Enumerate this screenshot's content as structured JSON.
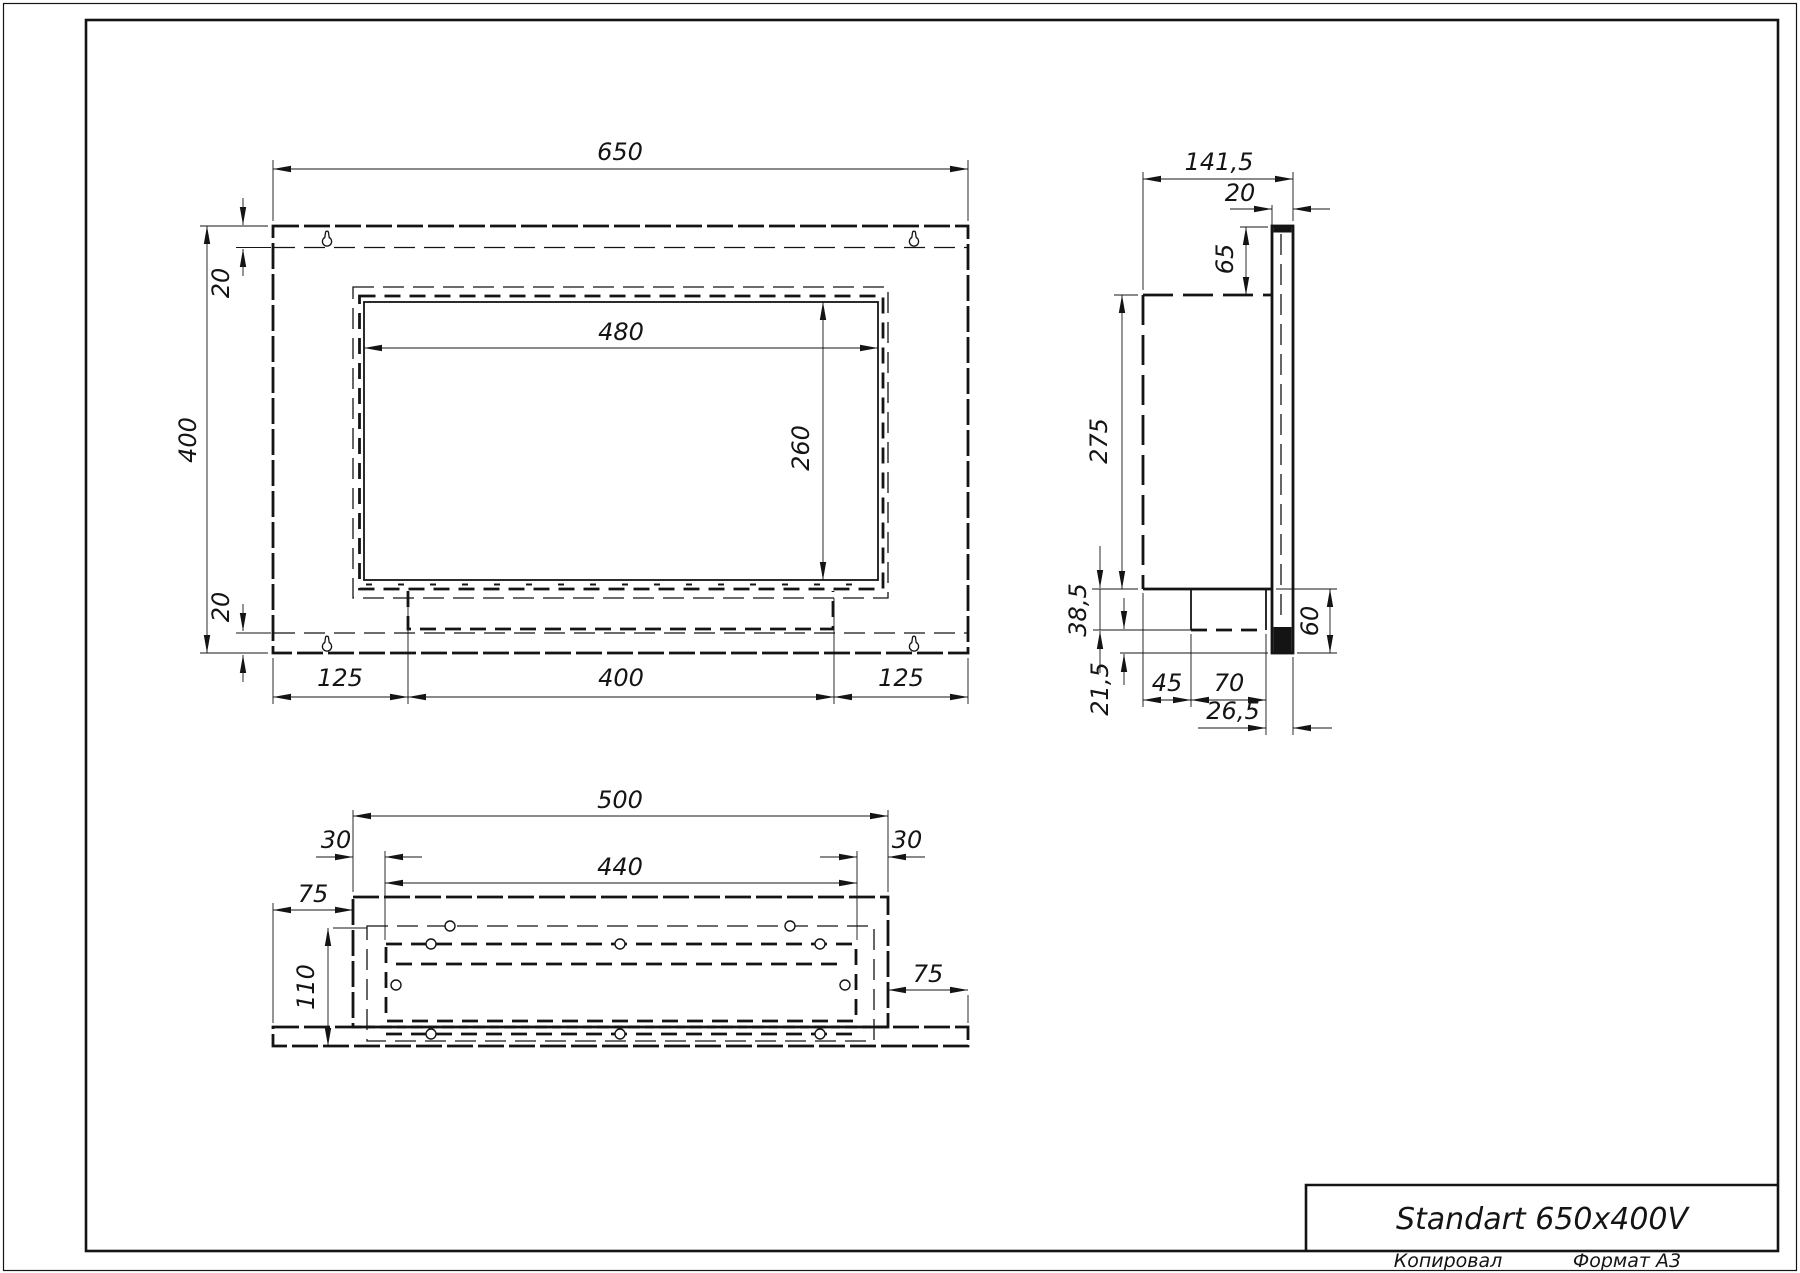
{
  "title_block": {
    "title": "Standart 650x400V",
    "footer_left": "Копировал",
    "footer_right": "Формат A3"
  },
  "front": {
    "width": "650",
    "height": "400",
    "top_inset": "20",
    "bottom_inset": "20",
    "opening_width": "480",
    "opening_height": "260",
    "bottom_left": "125",
    "bottom_center": "400",
    "bottom_right": "125"
  },
  "side": {
    "depth": "141,5",
    "flange_thickness": "20",
    "top_offset": "65",
    "body_height": "275",
    "base_offset": "38,5",
    "bottom_offset": "21,5",
    "front_clearance": "45",
    "base_depth": "70",
    "rear_clearance": "26,5",
    "lower_height": "60"
  },
  "bottom": {
    "casing_width": "500",
    "inset_left": "30",
    "inset_right": "30",
    "opening_width": "440",
    "flange_left": "75",
    "flange_right": "75",
    "depth": "110"
  }
}
